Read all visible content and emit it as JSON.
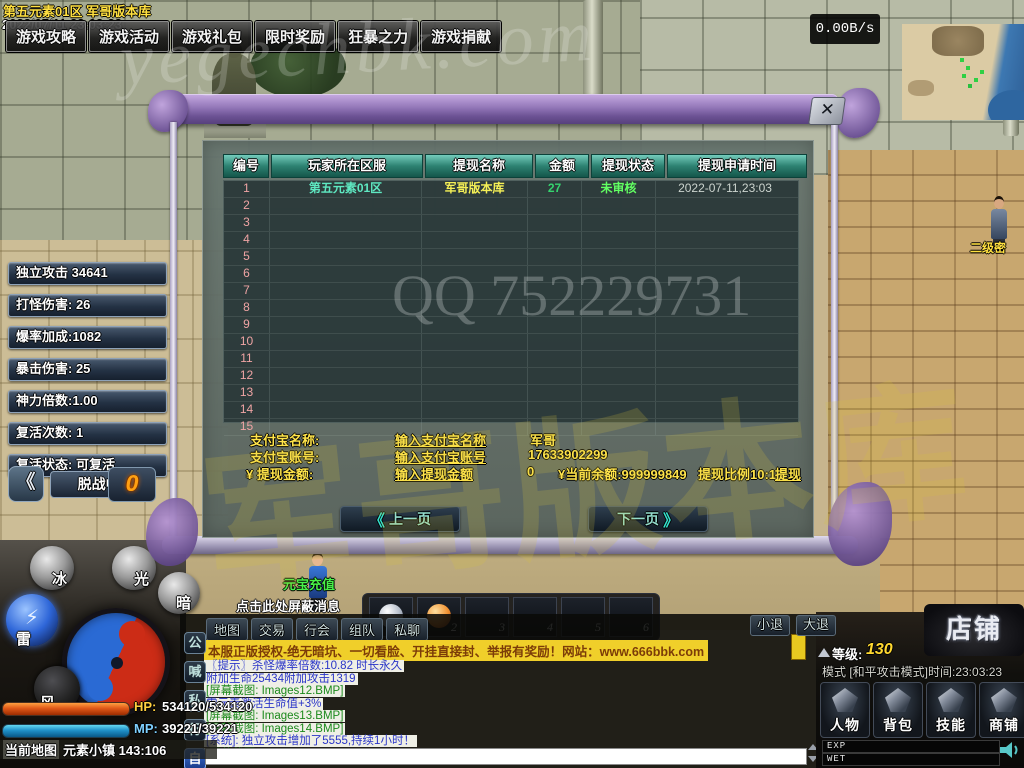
{
  "hud": {
    "server_title": "第五元素01区 军哥版本库",
    "datetime": "2022/07/11 23:03:23",
    "net_speed": "0.00B/s",
    "menu_items": [
      {
        "label": "游戏攻略"
      },
      {
        "label": "游戏活动"
      },
      {
        "label": "游戏礼包"
      },
      {
        "label": "限时奖励"
      },
      {
        "label": "狂暴之力"
      },
      {
        "label": "游戏捐献"
      }
    ]
  },
  "dialog": {
    "close_label": "✕",
    "table": {
      "headers": [
        "编号",
        "玩家所在区服",
        "提现名称",
        "金额",
        "提现状态",
        "提现申请时间"
      ],
      "rows": [
        {
          "id": "1",
          "zone": "第五元素01区",
          "name": "军哥版本库",
          "amount": "27",
          "status": "未审核",
          "time": "2022-07-11,23:03"
        },
        {
          "id": "2",
          "zone": "",
          "name": "",
          "amount": "",
          "status": "",
          "time": ""
        },
        {
          "id": "3",
          "zone": "",
          "name": "",
          "amount": "",
          "status": "",
          "time": ""
        },
        {
          "id": "4",
          "zone": "",
          "name": "",
          "amount": "",
          "status": "",
          "time": ""
        },
        {
          "id": "5",
          "zone": "",
          "name": "",
          "amount": "",
          "status": "",
          "time": ""
        },
        {
          "id": "6",
          "zone": "",
          "name": "",
          "amount": "",
          "status": "",
          "time": ""
        },
        {
          "id": "7",
          "zone": "",
          "name": "",
          "amount": "",
          "status": "",
          "time": ""
        },
        {
          "id": "8",
          "zone": "",
          "name": "",
          "amount": "",
          "status": "",
          "time": ""
        },
        {
          "id": "9",
          "zone": "",
          "name": "",
          "amount": "",
          "status": "",
          "time": ""
        },
        {
          "id": "10",
          "zone": "",
          "name": "",
          "amount": "",
          "status": "",
          "time": ""
        },
        {
          "id": "11",
          "zone": "",
          "name": "",
          "amount": "",
          "status": "",
          "time": ""
        },
        {
          "id": "12",
          "zone": "",
          "name": "",
          "amount": "",
          "status": "",
          "time": ""
        },
        {
          "id": "13",
          "zone": "",
          "name": "",
          "amount": "",
          "status": "",
          "time": ""
        },
        {
          "id": "14",
          "zone": "",
          "name": "",
          "amount": "",
          "status": "",
          "time": ""
        },
        {
          "id": "15",
          "zone": "",
          "name": "",
          "amount": "",
          "status": "",
          "time": ""
        }
      ]
    },
    "form": {
      "alipay_name_label": "支付宝名称:",
      "alipay_name_link": "输入支付宝名称",
      "alipay_name_value": "军哥",
      "alipay_account_label": "支付宝账号:",
      "alipay_account_link": "输入支付宝账号",
      "alipay_account_value": "17633902299",
      "amount_label": "¥ 提现金额:",
      "amount_link": "输入提现金额",
      "amount_value": "0",
      "balance_label": "¥当前余额:999999849",
      "ratio_label": "提现比例10:1",
      "withdraw_link": "提现"
    },
    "pagination": {
      "prev_arrow": "《",
      "prev": "上一页",
      "next": "下一页",
      "next_arrow": "》"
    }
  },
  "stats": {
    "items": [
      {
        "label": "独立攻击 34641"
      },
      {
        "label": "打怪伤害: 26"
      },
      {
        "label": "爆率加成:1082"
      },
      {
        "label": "暴击伤害: 25"
      },
      {
        "label": "神力倍数:1.00"
      },
      {
        "label": "复活次数: 1"
      },
      {
        "label": "复活状态: 可复活"
      }
    ],
    "back_arrow": "《",
    "combat_state": "脱战中:",
    "coin_value": "0"
  },
  "orbs": {
    "ice": "冰",
    "light": "光",
    "dark": "暗",
    "thunder": "雷",
    "thunder_glyph": "⚡",
    "wind": "风"
  },
  "vitals": {
    "hp_label": "HP:",
    "hp_value": "534120/534120",
    "mp_label": "MP:",
    "mp_value": "39221/39221",
    "map_label": "当前地图",
    "map_value": "元素小镇 143:106"
  },
  "world": {
    "block_tip": "点击此处屏蔽消息",
    "recharge_npc": "元宝充值",
    "right_npc": "二级密"
  },
  "skillbar": {
    "slots": [
      {
        "num": "1",
        "icon": "silver-orb"
      },
      {
        "num": "2",
        "icon": "orange-orb"
      },
      {
        "num": "3",
        "icon": ""
      },
      {
        "num": "4",
        "icon": ""
      },
      {
        "num": "5",
        "icon": ""
      },
      {
        "num": "6",
        "icon": ""
      }
    ]
  },
  "chat": {
    "tabs": [
      {
        "label": "地图"
      },
      {
        "label": "交易"
      },
      {
        "label": "行会"
      },
      {
        "label": "组队"
      },
      {
        "label": "私聊"
      }
    ],
    "exit_small": "小退",
    "exit_big": "大退",
    "channels": [
      {
        "label": "公",
        "active": "false"
      },
      {
        "label": "喊",
        "active": "false"
      },
      {
        "label": "私",
        "active": "false"
      },
      {
        "label": "行",
        "active": "false"
      },
      {
        "label": "自",
        "active": "true"
      }
    ],
    "banner": "本服正版授权-绝无暗坑、一切看脸、开挂直接封、举报有奖励！网站：www.666bbk.com",
    "lines": [
      {
        "text": "〖提示〗杀怪爆率倍数:10.82 时长永久",
        "fg": "#2a35c8",
        "bg": "#efefe6",
        "interactable": "false"
      },
      {
        "text": "附加生命25434附加攻击1319",
        "fg": "#2a35c8",
        "bg": "#efefe6",
        "interactable": "false"
      },
      {
        "text": "[屏幕截图: Images12.BMP]",
        "fg": "#1c8a1c",
        "bg": "#efefe6",
        "interactable": "true"
      },
      {
        "text": "雷元素激活生命值+3%",
        "fg": "#2a35c8",
        "bg": "#efefe6",
        "interactable": "false"
      },
      {
        "text": "[屏幕截图: Images13.BMP]",
        "fg": "#1c8a1c",
        "bg": "#efefe6",
        "interactable": "true"
      },
      {
        "text": "[屏幕截图: Images14.BMP]",
        "fg": "#1c8a1c",
        "bg": "#efefe6",
        "interactable": "true"
      },
      {
        "text": "[系统]: 独立攻击增加了5555,持续1小时！",
        "fg": "#2a35c8",
        "bg": "#efefe6",
        "interactable": "false"
      },
      {
        "text": "[屏幕截图: Images15.BMP]",
        "fg": "#1c8a1c",
        "bg": "#efefe6",
        "interactable": "true"
      }
    ]
  },
  "panel": {
    "shop_banner": "店铺",
    "level_label": "等级:",
    "level_value": "130",
    "mode_line": "模式 [和平攻击模式]时间:23:03:23",
    "buttons": [
      {
        "label": "人物"
      },
      {
        "label": "背包"
      },
      {
        "label": "技能"
      },
      {
        "label": "商铺"
      }
    ],
    "exp_label": "EXP",
    "wet_label": "WET"
  },
  "watermarks": {
    "site": "yegechbk.com",
    "qq": "QQ 752229731",
    "calligraphy": "军哥版本库"
  },
  "colors": {
    "accent_teal": "#35e0cc",
    "gold": "#ffe44a",
    "status_green": "#62ff62",
    "banner_yellow": "#f0cf2a"
  }
}
